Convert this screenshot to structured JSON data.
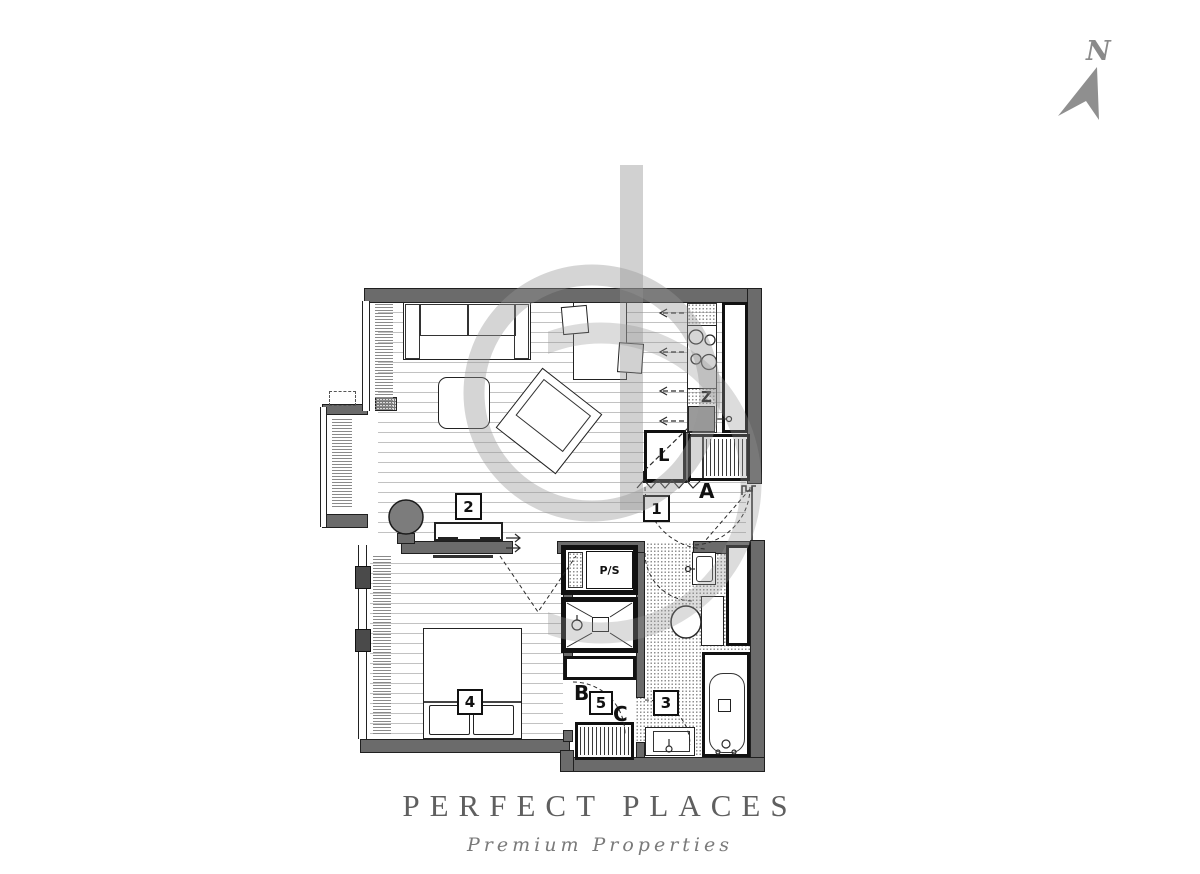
{
  "brand": {
    "name": "PERFECT PLACES",
    "tagline": "Premium Properties"
  },
  "compass": {
    "north_label": "N"
  },
  "plan": {
    "room_labels": [
      {
        "room": "hallway",
        "text": "1"
      },
      {
        "room": "living-room",
        "text": "2"
      },
      {
        "room": "bathroom",
        "text": "3"
      },
      {
        "room": "bedroom",
        "text": "4"
      },
      {
        "room": "inner-hall",
        "text": "5"
      }
    ],
    "door_labels": [
      {
        "door": "entrance",
        "text": "A"
      },
      {
        "door": "bedroom-to-inner-hall",
        "text": "B"
      },
      {
        "door": "inner-hall-to-bath",
        "text": "C"
      }
    ],
    "fixture_labels": [
      {
        "fixture": "kitchen-sink",
        "text": "Z"
      },
      {
        "fixture": "fridge",
        "text": "L"
      },
      {
        "fixture": "pipe-shaft",
        "text": "P/S"
      }
    ]
  },
  "colors": {
    "wall": "#6b6b6b",
    "outline": "#1f1f1f",
    "floor_line": "#c2c2c2",
    "watermark": "#a8a8a8",
    "brand_text": "#5f5f5f",
    "compass": "#8f8f8f"
  }
}
